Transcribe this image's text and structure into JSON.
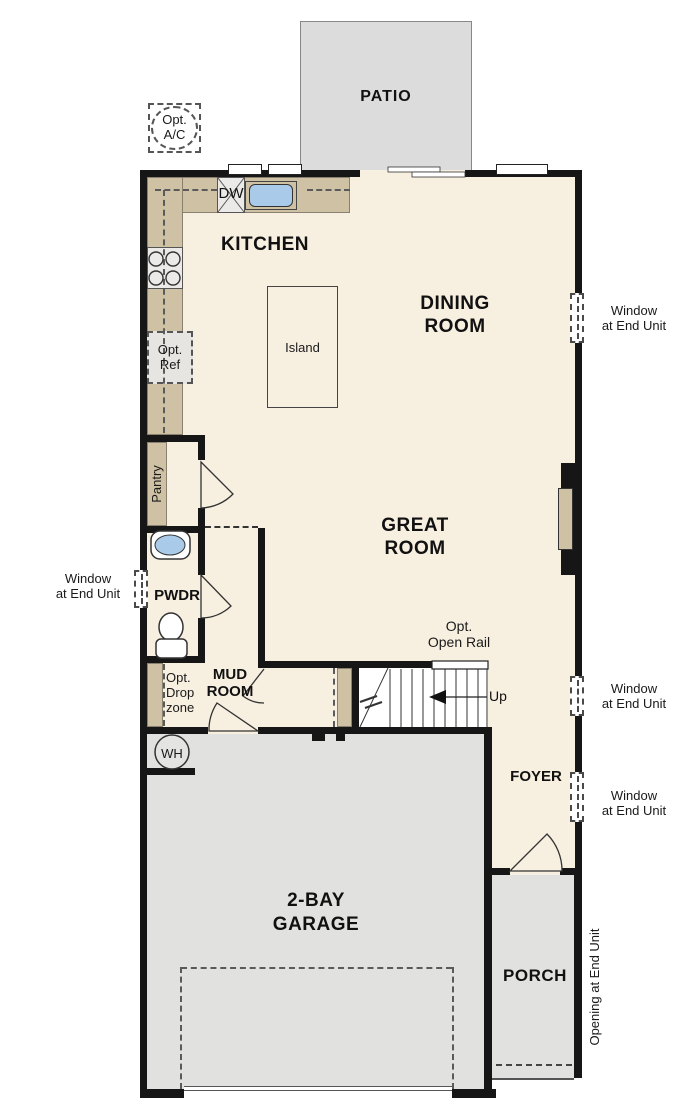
{
  "rooms": {
    "patio": "PATIO",
    "kitchen": "KITCHEN",
    "dining": "DINING\nROOM",
    "great": "GREAT\nROOM",
    "island": "Island",
    "pantry": "Pantry",
    "powder": "PWDR",
    "mud": "MUD\nROOM",
    "foyer": "FOYER",
    "garage": "2-BAY\nGARAGE",
    "porch": "PORCH"
  },
  "fixtures": {
    "dishwasher": "DW",
    "water_heater": "WH"
  },
  "options": {
    "ac": "Opt.\nA/C",
    "ref": "Opt.\nRef",
    "drop_zone": "Opt.\nDrop\nzone",
    "open_rail": "Opt.\nOpen Rail"
  },
  "stairs": {
    "direction": "Up"
  },
  "annotations": {
    "window_end_unit": "Window\nat End Unit",
    "opening_end_unit": "Opening at End Unit"
  },
  "colors": {
    "floor": "#f7efe0",
    "counter": "#cfc1a4",
    "concrete": "#e1e1df",
    "patio": "#dcdcdc",
    "wall": "#161616",
    "sink": "#a9cbe9",
    "appliance": "#eceae8"
  }
}
